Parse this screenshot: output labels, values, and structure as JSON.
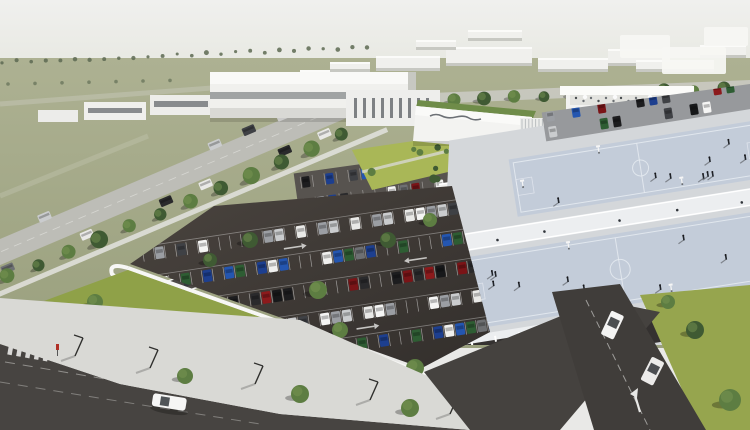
{
  "scene": {
    "type": "architectural-aerial-rendering",
    "description": "Aerial 3D architectural rendering of a planned commercial and sports complex: white modern buildings with an illegible cursive logo sign, two rooftop multi-sport courts with players, landscaped green decks, tree-lined roads, a large surface car park enclosed by a white perimeter wall, sidewalks with street lamps and an exit drive with lane arrows.",
    "building_sign": {
      "legible": false,
      "style": "cursive-logo"
    }
  },
  "palette": {
    "sky_top": "#f0f0ee",
    "sky_bottom": "#e2e4da",
    "field": "#adb192",
    "field_dark": "#9aa07e",
    "lawn": "#8fa148",
    "lawn_bright": "#a9b757",
    "asphalt": "#3e3a36",
    "asphalt_light": "#57534f",
    "road": "#474441",
    "sidewalk": "#d9d9d5",
    "wall": "#f6f6f4",
    "building": "#f0f0ed",
    "building_shade": "#c7c8c2",
    "window": "#5c6165",
    "deck": "#d4d7da",
    "walkway": "#eceef0",
    "court": "#c3ccd9",
    "court_line": "#e9edf3",
    "tree_dark": "#3f5a33",
    "tree_mid": "#5d7d42",
    "tree_light": "#7d9a55"
  },
  "cars": {
    "colors": [
      "#f5f5f4",
      "#1d1d1f",
      "#6e7073",
      "#9b9ea3",
      "#7a1417",
      "#1d3f8f",
      "#caccce",
      "#2a2a2c",
      "#f0f0ee",
      "#3f4145",
      "#8c1a1c",
      "#2456b0",
      "#e9e9e7",
      "#17181a",
      "#2e5d33"
    ]
  },
  "counts": {
    "distant_trees": 26,
    "avenue_trees": 13,
    "parking_rows": 5,
    "courts": 2,
    "players_per_court": [
      9,
      10
    ],
    "terrace_people": 14,
    "plaza_people": 9,
    "sidewalk_lamps": 5,
    "crosswalk_stripes": 5
  }
}
